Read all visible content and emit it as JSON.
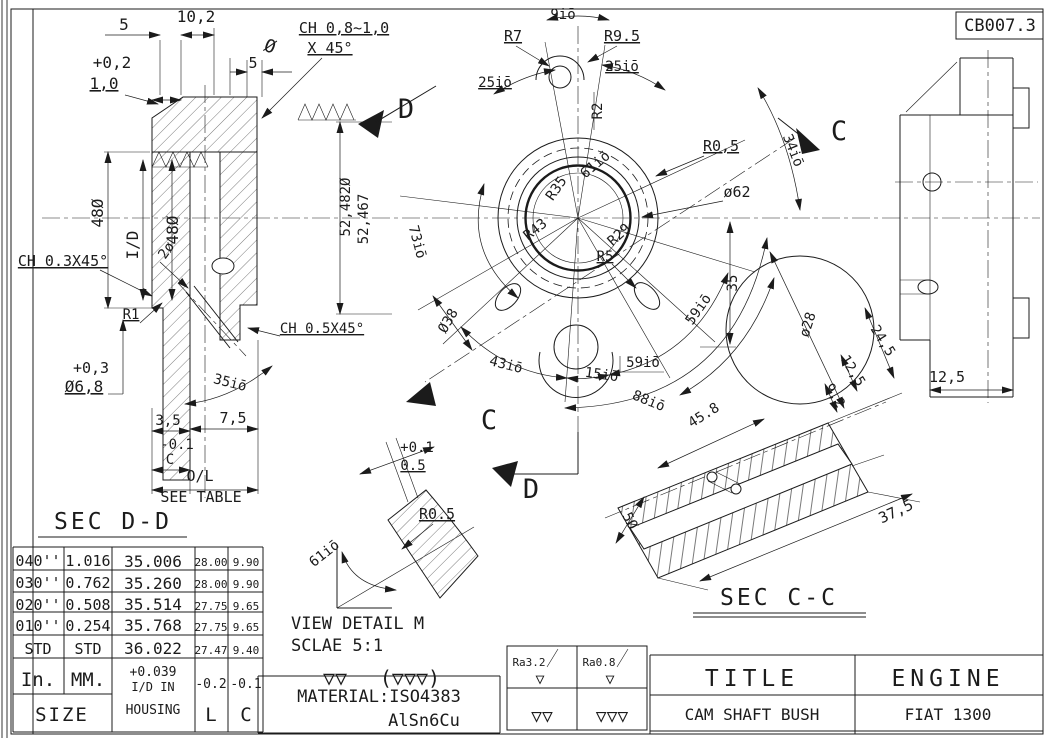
{
  "sheet": {
    "doc_number": "CB007.3"
  },
  "headings": {
    "sec_dd": "SEC D-D",
    "sec_cc": "SEC C-C",
    "view_detail": "VIEW DETAIL M",
    "scale_note": "SCLAE 5:1",
    "see_table": "SEE TABLE"
  },
  "left_view": {
    "dim_5": "5",
    "dim_10_2": "10,2",
    "tol_plus_0_2": "+0,2",
    "dim_1_0": "1,0",
    "dim_5_dia": "5",
    "dia_symbol": "Ø",
    "chamfer_top": "CH 0,8~1,0",
    "chamfer_top_2": "X 45°",
    "dia_48_outer": "48Ø",
    "bore_id": "I/D",
    "dia_48_inner": "48Ø",
    "chamfer_03": "CH 0.3X45°",
    "dim_2_dia": "2ø",
    "radius_r1": "R1",
    "tol_plus_0_3": "+0,3",
    "dia_6_8": "Ø6,8",
    "angle_35": "35iō",
    "chamfer_05": "CH 0.5X45°",
    "dim_3_5": "3,5",
    "dim_7_5": "7,5",
    "tol_minus_0_1": "-0.1",
    "dim_c": "C",
    "dim_ol": "O/L"
  },
  "front_view": {
    "angle_9": "9iō",
    "radius_r7": "R7",
    "radius_r9_5": "R9.5",
    "angle_25_left": "25iō",
    "angle_25_right": "25iō",
    "radius_r2": "R2",
    "angle_61": "61iō",
    "radius_r0_5": "R0,5",
    "radius_r35": "R35",
    "radius_r43": "R43",
    "angle_73": "73iō",
    "dia_52_482": "52,482Ø",
    "dim_52_467": "52,467",
    "dia_62": "ø62",
    "radius_r29": "R29",
    "radius_r5": "R5",
    "dim_35": "35",
    "dia_38": "Ø38",
    "angle_43": "43iō",
    "angle_15": "15iō",
    "angle_59_a": "59iō",
    "angle_59_b": "59iō",
    "angle_88": "88iō",
    "angle_34": "34iō",
    "letter_d_top": "D",
    "letter_d_bottom": "D",
    "letter_c_right": "C",
    "letter_c_bottom": "C"
  },
  "side_view": {
    "dim_12_5": "12,5"
  },
  "section_cc": {
    "dia_28": "ø28",
    "dim_24_5": "24,5",
    "dim_12_5": "12,5",
    "dim_9_2": "9,2",
    "dia_5": "5Ø",
    "dim_45_8": "45.8",
    "dim_37_5": "37,5"
  },
  "detail_m": {
    "tol_plus_0_1": "+0.1",
    "dim_0_5": "0.5",
    "radius_r0_5": "R0.5",
    "angle_61": "61iō",
    "tri_double": "▽▽",
    "tri_triple_bracket": "(▽▽▽)"
  },
  "table": {
    "rows": [
      {
        "size": "040''",
        "mm": "1.016",
        "id": "35.006",
        "l": "28.00",
        "c": "9.90"
      },
      {
        "size": "030''",
        "mm": "0.762",
        "id": "35.260",
        "l": "28.00",
        "c": "9.90"
      },
      {
        "size": "020''",
        "mm": "0.508",
        "id": "35.514",
        "l": "27.75",
        "c": "9.65"
      },
      {
        "size": "010''",
        "mm": "0.254",
        "id": "35.768",
        "l": "27.75",
        "c": "9.65"
      },
      {
        "size": "STD",
        "mm": "STD",
        "id": "36.022",
        "l": "27.47",
        "c": "9.40"
      }
    ],
    "footer": {
      "in": "In.",
      "mm": "MM.",
      "tol": "+0.039",
      "housing_1": "I/D IN",
      "housing_2": "HOUSING",
      "l_tol": "-0.2",
      "l": "L",
      "c_tol": "-0.1",
      "c": "C",
      "size": "SIZE"
    }
  },
  "material": {
    "line_1": "MATERIAL:ISO4383",
    "line_2": "AlSn6Cu"
  },
  "finish": {
    "ra_fine": "Ra3.2",
    "ra_finer": "Ra0.8",
    "tri_single": "▽",
    "tri_double": "▽▽",
    "tri_triple": "▽▽▽"
  },
  "title_block": {
    "title_label": "TITLE",
    "engine_label": "ENGINE",
    "part_name": "CAM SHAFT BUSH",
    "engine_model": "FIAT 1300"
  }
}
